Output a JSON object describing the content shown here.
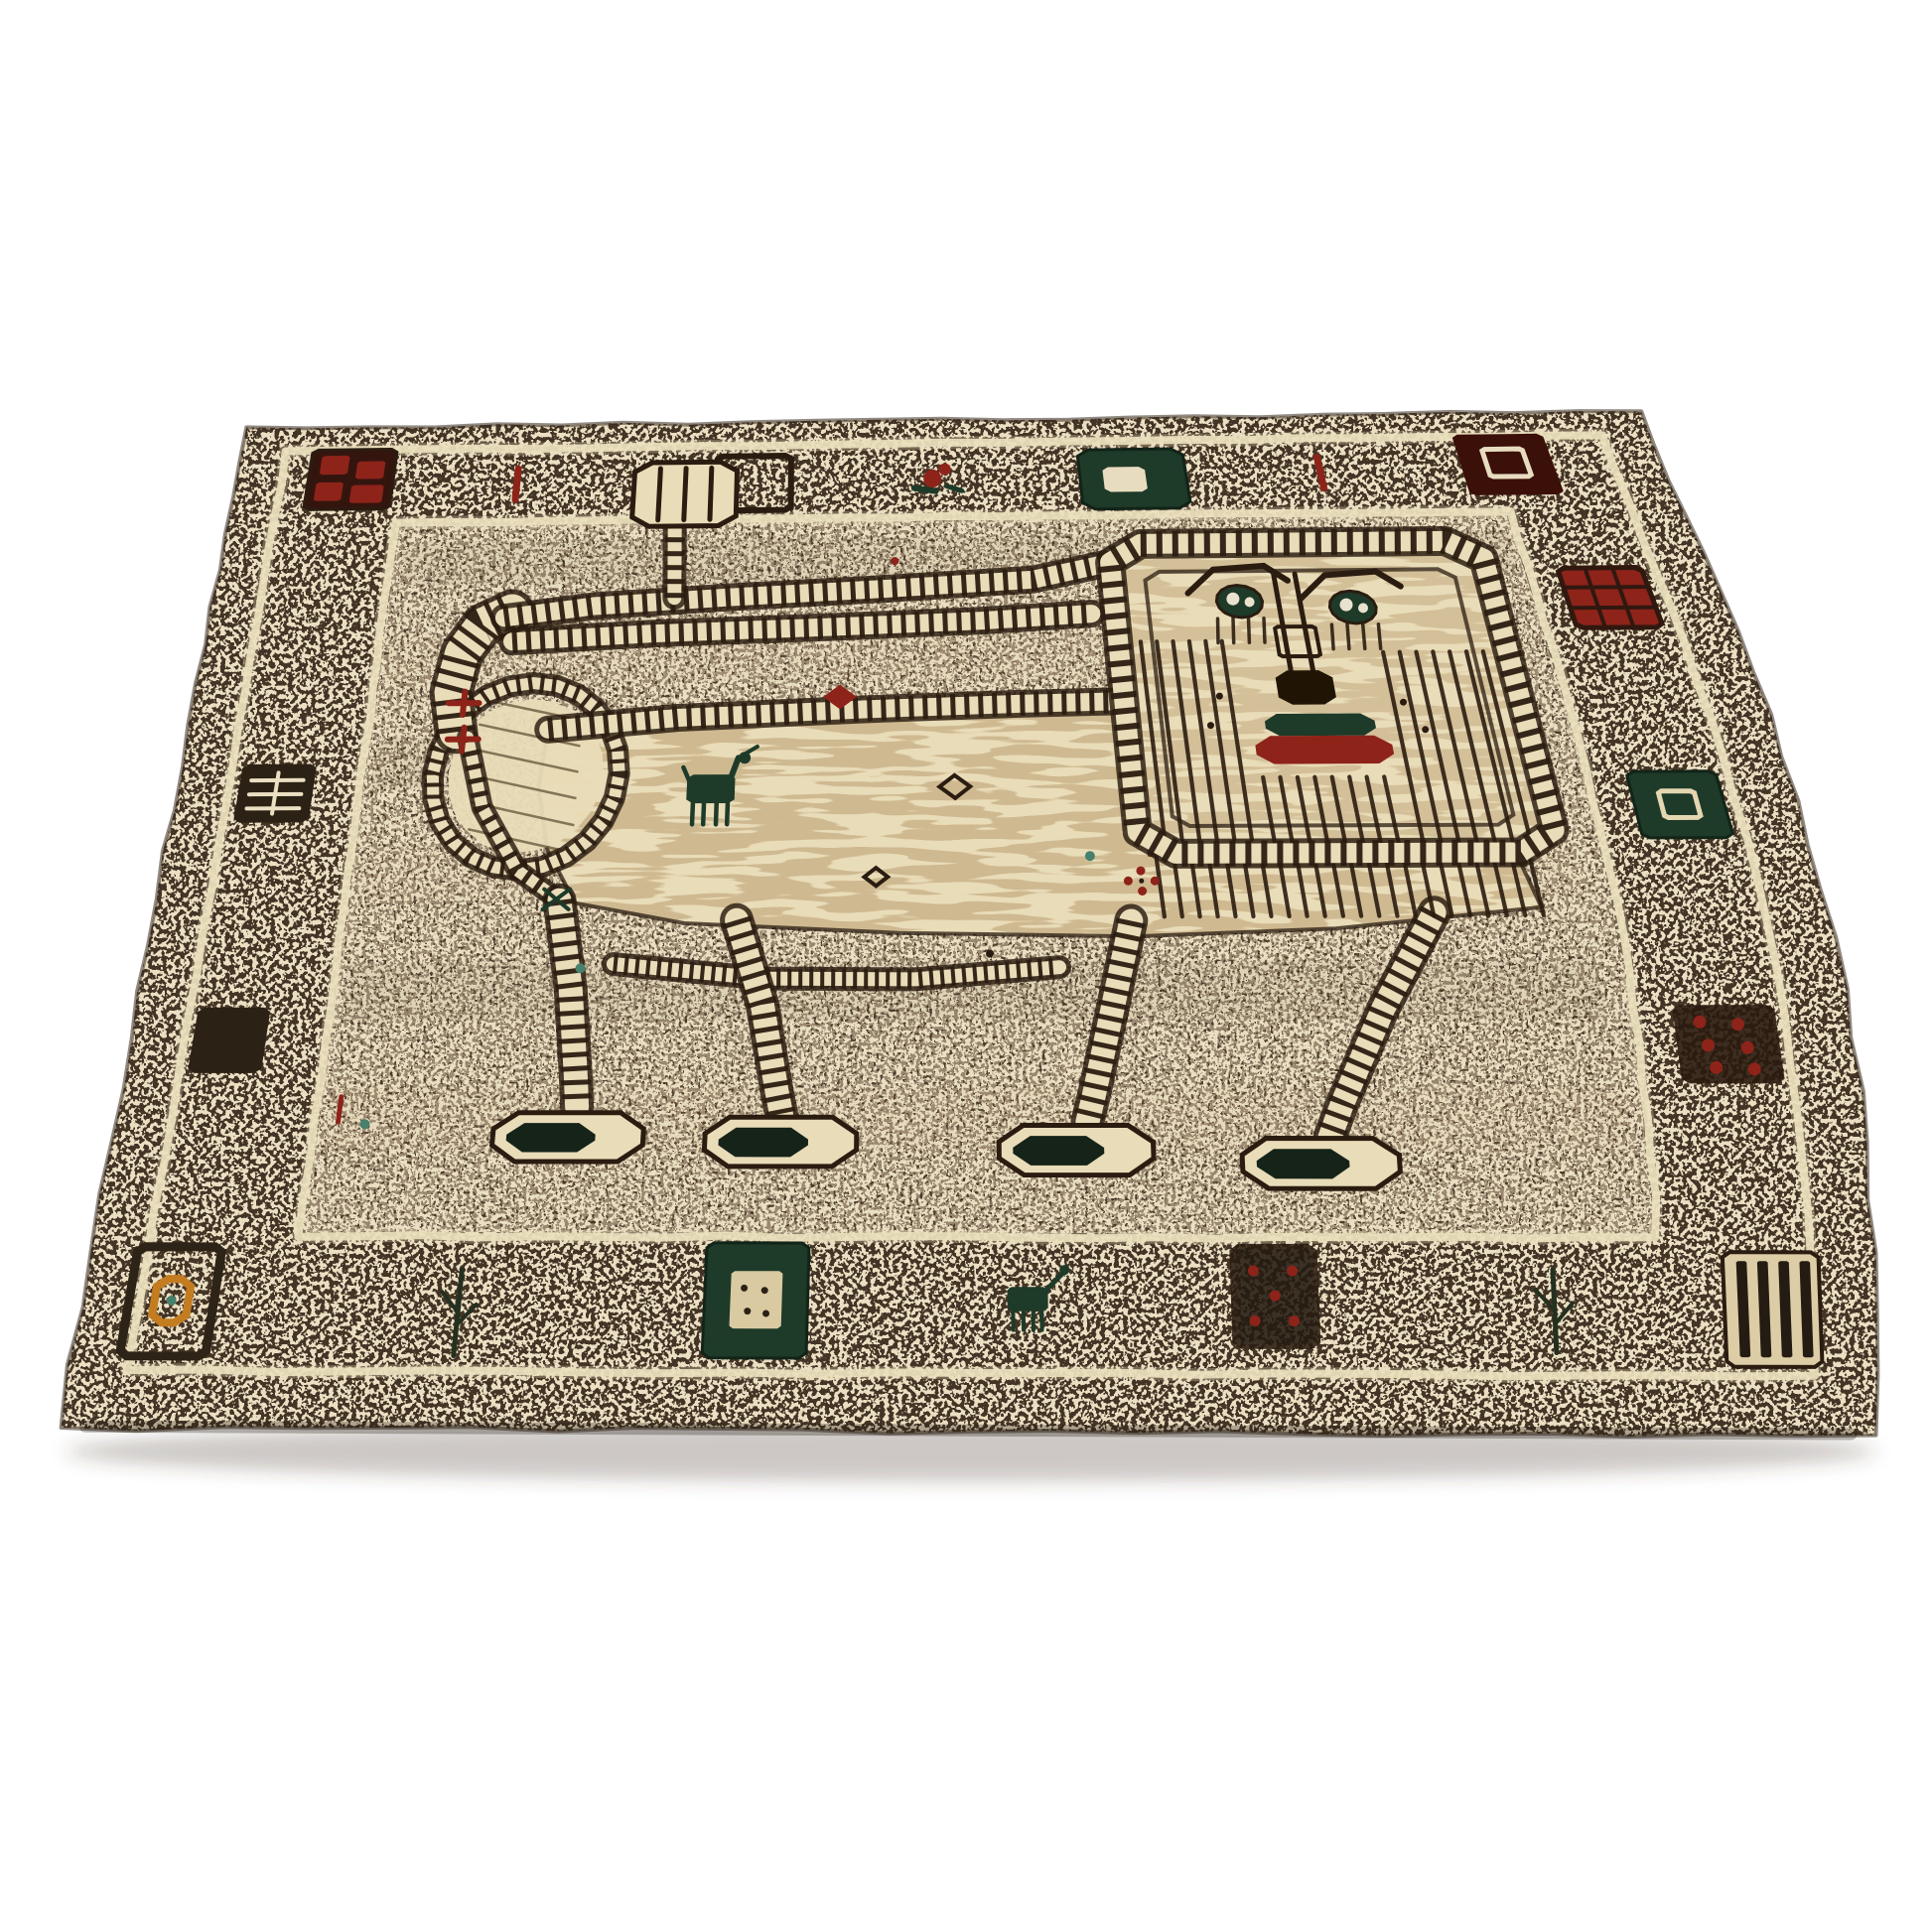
{
  "scene": {
    "description": "Hand-knotted wool Gabbeh-style rug with a large stylized lion motif, geometric border squares and a small goat figure, photographed at an angle on a white background",
    "palette": {
      "background": "#ffffff",
      "outline": "#2a1c10",
      "base": "#443426",
      "fleck": "#eadfc2",
      "field_base": "#99876f",
      "field_dark": "#3a2c1f",
      "lion": "#e9dcb8",
      "stripe": "#b99d72",
      "cream_line": "#eadfbd",
      "red": "#8e231a",
      "maroon": "#431109",
      "dark_green": "#1e3a29",
      "pad": "#152319",
      "orange": "#c47c20",
      "teal": "#47806c",
      "nose": "#201505",
      "shadow": "rgba(75,62,48,0.28)"
    },
    "rug": {
      "corners": {
        "tl": [
          246,
          432
        ],
        "tr": [
          1652,
          414
        ],
        "br": [
          1892,
          1446
        ],
        "bl": [
          58,
          1438
        ]
      },
      "foreshorten": 1.36,
      "bow_right": 72,
      "guard1": [
        0.033,
        0.031,
        0.965,
        0.957
      ],
      "guard2": [
        0.118,
        0.126,
        0.883,
        0.851
      ],
      "field": [
        0.121,
        0.13,
        0.88,
        0.848
      ]
    },
    "border_motifs": [
      {
        "id": "corner-pinwheel-square",
        "type": "pinwheel",
        "box": [
          0.052,
          0.03,
          0.112,
          0.108
        ]
      },
      {
        "id": "red-dash-top-1",
        "type": "dash",
        "box": [
          0.196,
          0.058,
          0.203,
          0.098
        ]
      },
      {
        "id": "open-square-top",
        "type": "open_square",
        "box": [
          0.34,
          0.045,
          0.392,
          0.115
        ]
      },
      {
        "id": "bird-motif-top",
        "type": "bird",
        "box": [
          0.478,
          0.06,
          0.504,
          0.094
        ]
      },
      {
        "id": "green-rect-top",
        "type": "green_rect",
        "box": [
          0.594,
          0.042,
          0.668,
          0.118
        ]
      },
      {
        "id": "red-dash-top-2",
        "type": "dash",
        "box": [
          0.758,
          0.055,
          0.765,
          0.095
        ]
      },
      {
        "id": "corner-maroon-square",
        "type": "maroon_square",
        "box": [
          0.86,
          0.028,
          0.924,
          0.106
        ]
      },
      {
        "id": "red-grid-right",
        "type": "red_grid",
        "box": [
          0.902,
          0.196,
          0.956,
          0.266
        ]
      },
      {
        "id": "green-square-right",
        "type": "green_square",
        "box": [
          0.906,
          0.424,
          0.958,
          0.492
        ]
      },
      {
        "id": "red-dot-square-right",
        "type": "red_dot_square",
        "box": [
          0.904,
          0.652,
          0.96,
          0.722
        ]
      },
      {
        "id": "dark-grid-left",
        "type": "dark_grid",
        "box": [
          0.04,
          0.408,
          0.088,
          0.47
        ]
      },
      {
        "id": "dark-square-left",
        "type": "dark_square",
        "box": [
          0.038,
          0.652,
          0.082,
          0.712
        ]
      },
      {
        "id": "corner-orange-ring-square",
        "type": "corner_ring",
        "box": [
          0.027,
          0.86,
          0.075,
          0.946
        ]
      },
      {
        "id": "plant-bottom-1",
        "type": "plant",
        "box": [
          0.205,
          0.878,
          0.222,
          0.945
        ]
      },
      {
        "id": "green-speck-square-bottom",
        "type": "green_speck_square",
        "box": [
          0.352,
          0.856,
          0.41,
          0.946
        ]
      },
      {
        "id": "green-animal-bottom",
        "type": "green_animal",
        "box": [
          0.52,
          0.872,
          0.554,
          0.924
        ]
      },
      {
        "id": "red-dot-square-bottom",
        "type": "red_dot_square2",
        "box": [
          0.648,
          0.858,
          0.694,
          0.936
        ]
      },
      {
        "id": "plant-bottom-2",
        "type": "plant",
        "box": [
          0.818,
          0.876,
          0.832,
          0.94
        ]
      },
      {
        "id": "corner-stripes-square",
        "type": "stripes_square",
        "box": [
          0.918,
          0.862,
          0.97,
          0.95
        ]
      }
    ],
    "lion": {
      "body": [
        [
          0.236,
          0.372
        ],
        [
          0.31,
          0.358
        ],
        [
          0.43,
          0.35
        ],
        [
          0.53,
          0.346
        ],
        [
          0.608,
          0.344
        ],
        [
          0.612,
          0.43
        ],
        [
          0.614,
          0.507
        ],
        [
          0.72,
          0.509
        ],
        [
          0.832,
          0.512
        ],
        [
          0.84,
          0.56
        ],
        [
          0.72,
          0.58
        ],
        [
          0.6,
          0.587
        ],
        [
          0.46,
          0.583
        ],
        [
          0.33,
          0.573
        ],
        [
          0.262,
          0.553
        ],
        [
          0.242,
          0.5
        ],
        [
          0.233,
          0.435
        ]
      ],
      "bands": [
        {
          "id": "tail-hook",
          "pts": [
            [
              0.176,
              0.374
            ],
            [
              0.17,
              0.33
            ],
            [
              0.174,
              0.285
            ],
            [
              0.186,
              0.252
            ],
            [
              0.205,
              0.236
            ]
          ],
          "w": 36
        },
        {
          "id": "tail-top",
          "pts": [
            [
              0.2,
              0.244
            ],
            [
              0.26,
              0.231
            ],
            [
              0.35,
              0.222
            ],
            [
              0.46,
              0.213
            ],
            [
              0.555,
              0.204
            ],
            [
              0.604,
              0.186
            ]
          ],
          "w": 20
        },
        {
          "id": "tail-under",
          "pts": [
            [
              0.207,
              0.272
            ],
            [
              0.3,
              0.264
            ],
            [
              0.42,
              0.258
            ],
            [
              0.52,
              0.252
            ],
            [
              0.592,
              0.245
            ]
          ],
          "w": 20
        },
        {
          "id": "back-band",
          "pts": [
            [
              0.236,
              0.372
            ],
            [
              0.32,
              0.36
            ],
            [
              0.44,
              0.352
            ],
            [
              0.54,
              0.347
            ],
            [
              0.606,
              0.345
            ]
          ],
          "w": 20
        },
        {
          "id": "comb-stem",
          "pts": [
            [
              0.314,
              0.222
            ],
            [
              0.312,
              0.136
            ]
          ],
          "w": 16
        },
        {
          "id": "rump-band",
          "pts": [
            [
              0.184,
              0.38
            ],
            [
              0.198,
              0.455
            ],
            [
              0.224,
              0.52
            ],
            [
              0.25,
              0.548
            ]
          ],
          "w": 14
        },
        {
          "id": "belly-band",
          "pts": [
            [
              0.288,
              0.612
            ],
            [
              0.38,
              0.626
            ],
            [
              0.47,
              0.627
            ],
            [
              0.556,
              0.616
            ]
          ],
          "w": 16,
          "dash": "4 7"
        },
        {
          "id": "leg-rear-1",
          "pts": [
            [
              0.252,
              0.55
            ],
            [
              0.263,
              0.635
            ],
            [
              0.27,
              0.715
            ],
            [
              0.272,
              0.742
            ]
          ],
          "w": 26
        },
        {
          "id": "leg-rear-2",
          "pts": [
            [
              0.362,
              0.57
            ],
            [
              0.379,
              0.65
            ],
            [
              0.389,
              0.728
            ],
            [
              0.392,
              0.748
            ]
          ],
          "w": 26
        },
        {
          "id": "leg-front-1",
          "pts": [
            [
              0.6,
              0.572
            ],
            [
              0.586,
              0.655
            ],
            [
              0.573,
              0.733
            ],
            [
              0.569,
              0.755
            ]
          ],
          "w": 26
        },
        {
          "id": "leg-front-2",
          "pts": [
            [
              0.778,
              0.565
            ],
            [
              0.742,
              0.655
            ],
            [
              0.714,
              0.74
            ],
            [
              0.706,
              0.768
            ]
          ],
          "w": 26
        }
      ],
      "comb": {
        "box": [
          0.282,
          0.052,
          0.354,
          0.134
        ],
        "fingers": [
          0.3,
          0.318,
          0.336
        ]
      },
      "haunch": {
        "c": [
          0.224,
          0.42
        ],
        "rx": 0.06,
        "ry": 0.1
      },
      "feet": [
        [
          0.268,
          0.768
        ],
        [
          0.392,
          0.772
        ],
        [
          0.562,
          0.779
        ],
        [
          0.7,
          0.79
        ]
      ],
      "foot_size": [
        0.088,
        0.042
      ],
      "head": {
        "box": [
          0.608,
          0.162,
          0.856,
          0.506
        ],
        "r": 0.022,
        "inner": [
          0.63,
          0.196,
          0.834,
          0.478
        ]
      },
      "eyes": [
        [
          0.69,
          0.232
        ],
        [
          0.763,
          0.24
        ]
      ],
      "nose": {
        "lines": [
          0.7155,
          0.7295
        ],
        "v0": 0.2,
        "v1": 0.312,
        "box": [
          0.71,
          0.262,
          0.736,
          0.296
        ],
        "tip": [
          0.705,
          0.312,
          0.741,
          0.35
        ]
      },
      "mouth": {
        "green": [
          0.694,
          0.36,
          0.762,
          0.384
        ],
        "red": [
          0.686,
          0.384,
          0.77,
          0.414
        ]
      },
      "whiskers": [
        [
          0.668,
          0.34
        ],
        [
          0.66,
          0.372
        ],
        [
          0.782,
          0.348
        ],
        [
          0.792,
          0.378
        ]
      ],
      "mane": {
        "step": 0.0105,
        "cols": [
          {
            "u0": 0.622,
            "u1": 0.678,
            "v0": 0.278,
            "v1": 0.492
          },
          {
            "u0": 0.776,
            "u1": 0.842,
            "v0": 0.292,
            "v1": 0.496
          },
          {
            "u0": 0.688,
            "u1": 0.766,
            "v0": 0.428,
            "v1": 0.496
          },
          {
            "u0": 0.618,
            "u1": 0.846,
            "v0": 0.51,
            "v1": 0.568
          }
        ]
      },
      "crosses": [
        [
          0.179,
          0.342
        ],
        [
          0.181,
          0.382
        ]
      ]
    },
    "goat": {
      "body": [
        0.329,
        0.424,
        0.357,
        0.45
      ],
      "legs": [
        0.332,
        0.339,
        0.347,
        0.354
      ],
      "legv": [
        0.45,
        0.474
      ],
      "head": [
        0.36,
        0.404
      ],
      "tail": [
        0.325,
        0.414
      ]
    },
    "field_motifs": [
      {
        "t": "diamond",
        "u": 0.425,
        "v": 0.338,
        "s": 0.011,
        "c": "red",
        "fill": 1
      },
      {
        "t": "dot",
        "u": 0.463,
        "v": 0.18,
        "r": 4,
        "c": "red"
      },
      {
        "t": "diamond",
        "u": 0.497,
        "v": 0.436,
        "s": 0.012,
        "c": "outline",
        "fill": 0
      },
      {
        "t": "diamond",
        "u": 0.447,
        "v": 0.528,
        "s": 0.009,
        "c": "outline",
        "fill": 0
      },
      {
        "t": "dot",
        "u": 0.578,
        "v": 0.508,
        "r": 5,
        "c": "teal"
      },
      {
        "t": "flower",
        "u": 0.608,
        "v": 0.533,
        "c": "red"
      },
      {
        "t": "sprig",
        "u": 0.25,
        "v": 0.549,
        "c": "dark_green"
      },
      {
        "t": "dash2",
        "u": 0.132,
        "v": 0.744,
        "c": "red"
      },
      {
        "t": "dot",
        "u": 0.148,
        "v": 0.757,
        "r": 5,
        "c": "teal"
      },
      {
        "t": "dot",
        "u": 0.268,
        "v": 0.616,
        "r": 5,
        "c": "teal"
      },
      {
        "t": "dot",
        "u": 0.515,
        "v": 0.603,
        "r": 4,
        "c": "outline"
      }
    ]
  }
}
